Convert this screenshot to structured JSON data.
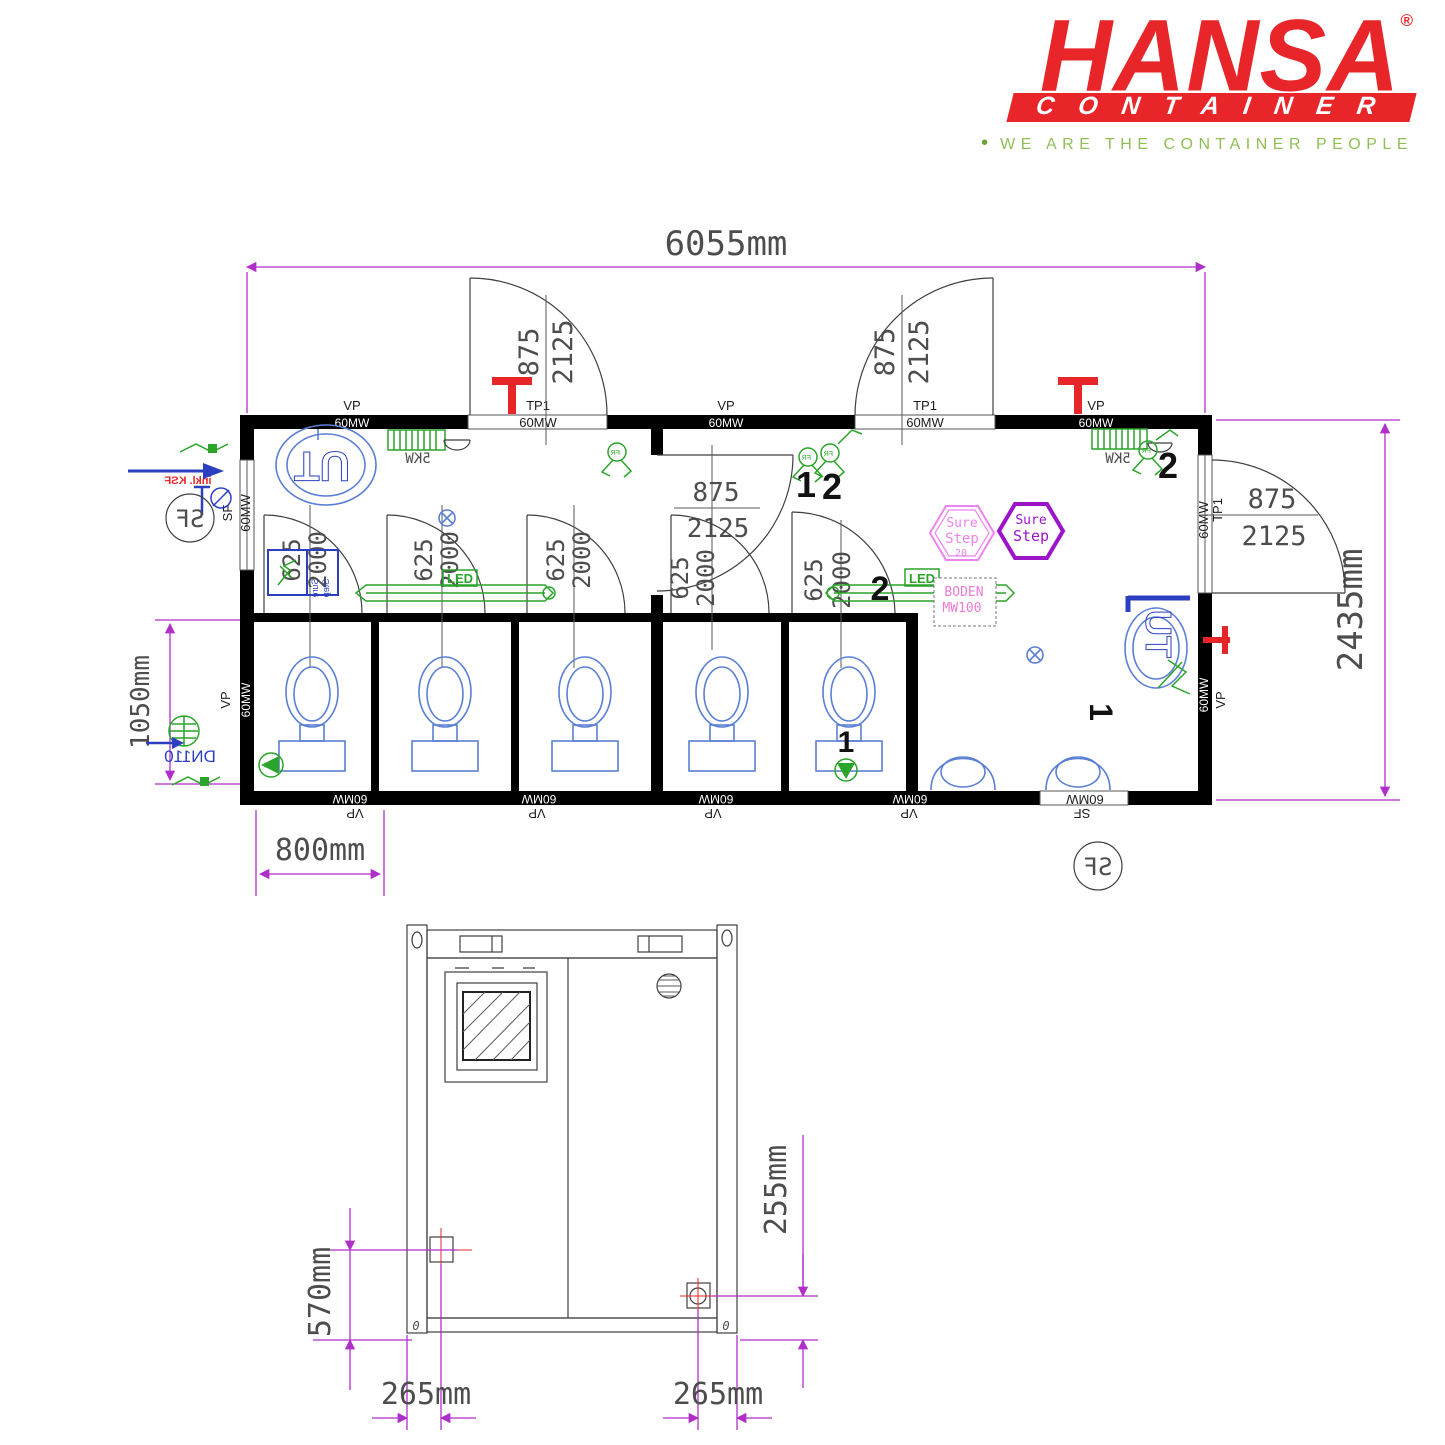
{
  "brand": {
    "name": "HANSA",
    "reg": "®",
    "sub": "CONTAINER",
    "bullet": "•",
    "tagline": "WE ARE THE CONTAINER PEOPLE",
    "red": "#e8262a",
    "green": "#8fbe56"
  },
  "plan": {
    "dims": {
      "width": "6055mm",
      "height": "2435mm",
      "inner": "1050mm",
      "stall": "800mm"
    },
    "door": {
      "w": "875",
      "h": "2125"
    },
    "stall_door": {
      "w": "625",
      "h": "2000"
    },
    "labels": {
      "vp": "VP",
      "mw60": "60MW",
      "tp1": "TP1",
      "sf": "SF",
      "kw5": "5KW",
      "led": "LED",
      "ut": "UT",
      "fr": "FR",
      "dn110": "DN110",
      "inkl": "inkl. KSF",
      "boden": "BODEN",
      "mw100": "MW100",
      "no1": "1",
      "no2": "2"
    },
    "surestep": {
      "sure": "Sure",
      "step": "Step",
      "size": "20"
    },
    "colors": {
      "dimension": "#b02fc8",
      "fixture": "#5b7fd4",
      "electric": "#2aa42a",
      "heating": "#e8262a",
      "surestep_pink": "#ee82ee",
      "surestep_violet": "#9b14c8"
    }
  },
  "elev": {
    "dims": {
      "left": "570mm",
      "right": "255mm",
      "bottom_left": "265mm",
      "bottom_right": "265mm"
    },
    "zero": "0"
  }
}
